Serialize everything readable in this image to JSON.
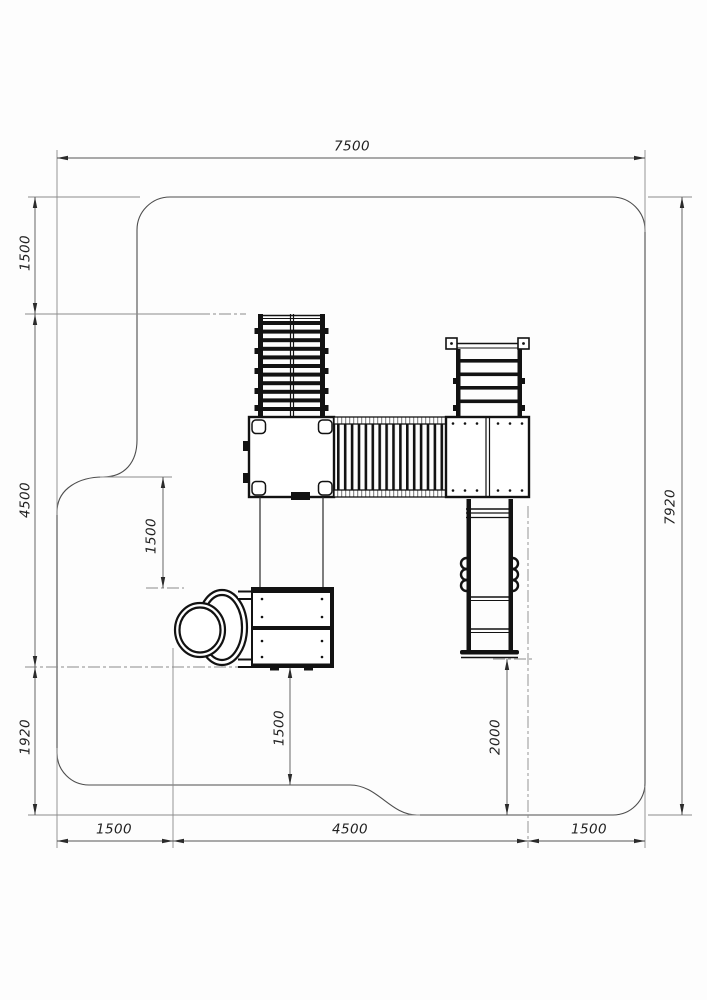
{
  "drawing": {
    "kind": "playground-equipment-safety-zone-plan",
    "units": "mm",
    "background": "#fdfdfd",
    "line_color": "#111111",
    "dim_line_color": "#555555"
  },
  "dims": {
    "top_width": "7500",
    "right_height": "7920",
    "left_top": "1500",
    "left_middle": "4500",
    "left_bottom": "1920",
    "inner_platform": "1500",
    "inner_exit": "1500",
    "inner_clearance": "2000",
    "bottom_left": "1500",
    "bottom_middle": "4500",
    "bottom_right": "1500"
  },
  "components": [
    "safety-zone-outline",
    "climbing-net-ladder",
    "rung-ladder",
    "left-platform",
    "rope-bridge",
    "right-platform",
    "straight-slide",
    "slide-chute",
    "lower-platform",
    "spiral-tube-slide"
  ]
}
